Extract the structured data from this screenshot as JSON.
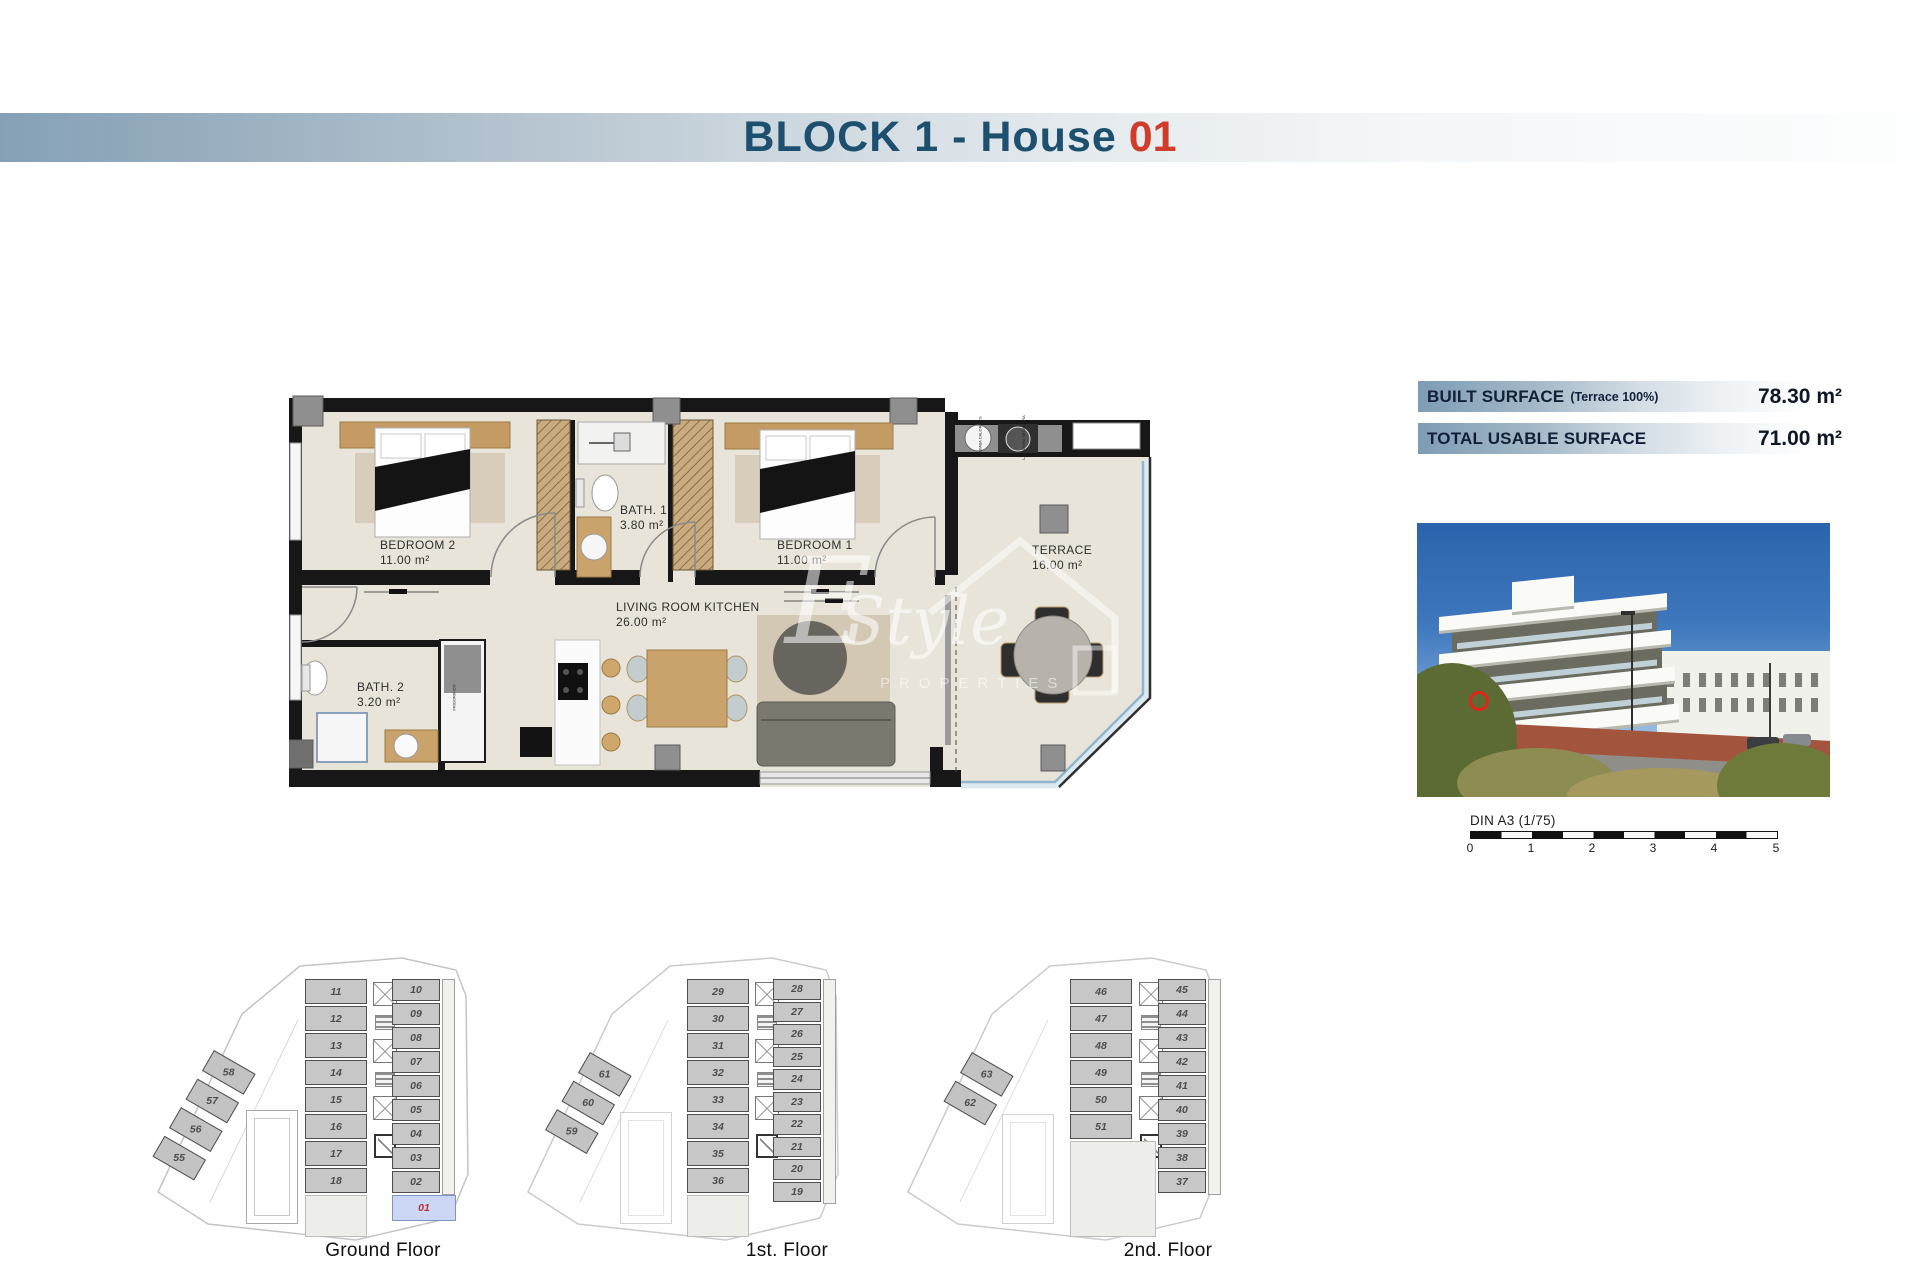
{
  "banner": {
    "title_prefix": "BLOCK 1 - House",
    "title_number": "01"
  },
  "surface_table": {
    "rows": [
      {
        "label": "BUILT SURFACE",
        "note": "(Terrace 100%)",
        "value": "78.30 m²"
      },
      {
        "label": "TOTAL USABLE SURFACE",
        "note": "",
        "value": "71.00 m²"
      }
    ]
  },
  "plan": {
    "rooms": [
      {
        "name": "BEDROOM 2",
        "area": "11.00 m²"
      },
      {
        "name": "BATH. 1",
        "area": "3.80 m²"
      },
      {
        "name": "BEDROOM 1",
        "area": "11.00 m²"
      },
      {
        "name": "TERRACE",
        "area": "16.00 m²"
      },
      {
        "name": "LIVING ROOM KITCHEN",
        "area": "26.00 m²"
      },
      {
        "name": "BATH. 2",
        "area": "3.20 m²"
      }
    ],
    "equipment": {
      "heat_pump": "BOMBA CALOR ACS",
      "washer_dryer": "LAVADORA SECADORA",
      "fridge": "FRIGORIFICO"
    }
  },
  "watermark": {
    "initial": "E",
    "script": "Style",
    "caps": "PROPERTIES"
  },
  "scale_bar": {
    "label": "DIN A3 (1/75)",
    "ticks": [
      "0",
      "1",
      "2",
      "3",
      "4",
      "5"
    ]
  },
  "floors": [
    {
      "label": "Ground Floor",
      "left": [
        "11",
        "12",
        "13",
        "14",
        "15",
        "16",
        "17",
        "18"
      ],
      "right": [
        "10",
        "09",
        "08",
        "07",
        "06",
        "05",
        "04",
        "03",
        "02"
      ],
      "highlight": "01",
      "wing": [
        "58",
        "57",
        "56",
        "55"
      ]
    },
    {
      "label": "1st. Floor",
      "left": [
        "29",
        "30",
        "31",
        "32",
        "33",
        "34",
        "35",
        "36"
      ],
      "right": [
        "28",
        "27",
        "26",
        "25",
        "24",
        "23",
        "22",
        "21",
        "20",
        "19"
      ],
      "highlight": "",
      "wing": [
        "61",
        "60",
        "59"
      ]
    },
    {
      "label": "2nd. Floor",
      "left": [
        "46",
        "47",
        "48",
        "49",
        "50",
        "51"
      ],
      "right": [
        "45",
        "44",
        "43",
        "42",
        "41",
        "40",
        "39",
        "38",
        "37"
      ],
      "highlight": "",
      "wing": [
        "63",
        "62"
      ]
    }
  ],
  "colors": {
    "banner_navy": "#1d4f6e",
    "banner_red": "#d13c2a",
    "surface_bar_blue": "#7d9cb5",
    "floor_cream": "#e9e4d9",
    "wall_black": "#171717",
    "wardrobe_tan": "#c9ab80",
    "unit_cell_gray": "#c7c7c7",
    "highlight_cell_blue": "#ccd7f3",
    "highlight_number_red": "#b23431",
    "terrace_glass_blue": "#8fb6cc",
    "photo_marker_red": "#e1251b"
  }
}
